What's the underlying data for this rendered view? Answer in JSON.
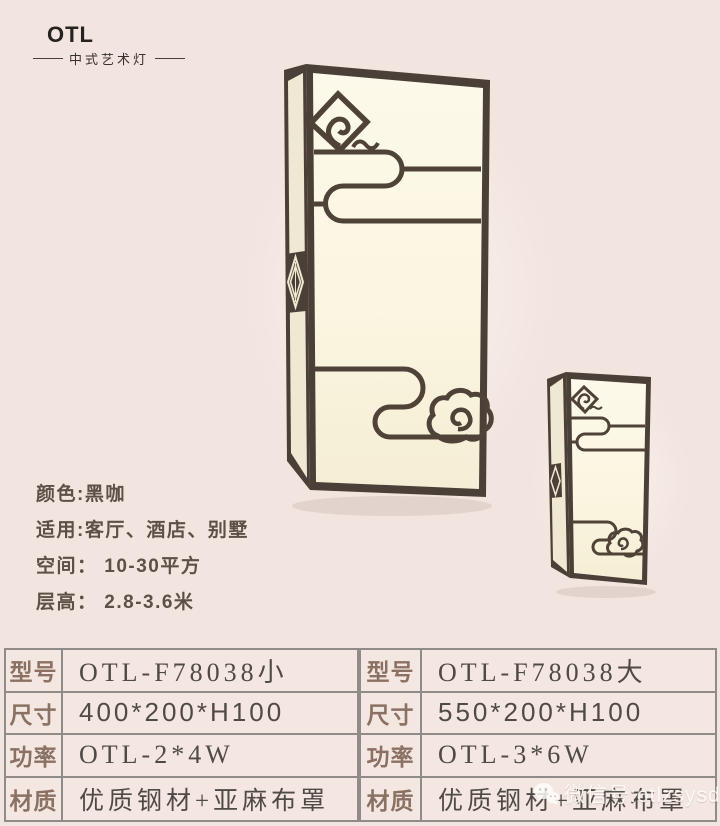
{
  "colors": {
    "background": "#f2e4de",
    "lamp_frame": "#4b4037",
    "lamp_shade": "#fbf6e3",
    "lamp_shade_side": "#efe8d2",
    "pattern_lines": "#4f4338",
    "table_border": "#8f8b88",
    "table_label_text": "#8b7164",
    "table_value_text": "#4f4a45",
    "info_text": "#5c5047",
    "brand_text": "#262220"
  },
  "brand": {
    "name": "OTL",
    "tagline": "中式艺术灯"
  },
  "info": {
    "lines": [
      "颜色:黑咖",
      "适用:客厅、酒店、别墅",
      "空间： 10-30平方",
      "层高： 2.8-3.6米"
    ]
  },
  "spec_tables": [
    {
      "rows": [
        {
          "label": "型号",
          "value": "OTL-F78038小"
        },
        {
          "label": "尺寸",
          "value": "400*200*H100"
        },
        {
          "label": "功率",
          "value": "OTL-2*4W"
        },
        {
          "label": "材质",
          "value": "优质钢材+亚麻布罩"
        }
      ]
    },
    {
      "rows": [
        {
          "label": "型号",
          "value": "OTL-F78038大"
        },
        {
          "label": "尺寸",
          "value": "550*200*H100"
        },
        {
          "label": "功率",
          "value": "OTL-3*6W"
        },
        {
          "label": "材质",
          "value": "优质钢材+亚麻布罩"
        }
      ]
    }
  ],
  "watermark": {
    "text": "微信号:otlzsysd"
  }
}
